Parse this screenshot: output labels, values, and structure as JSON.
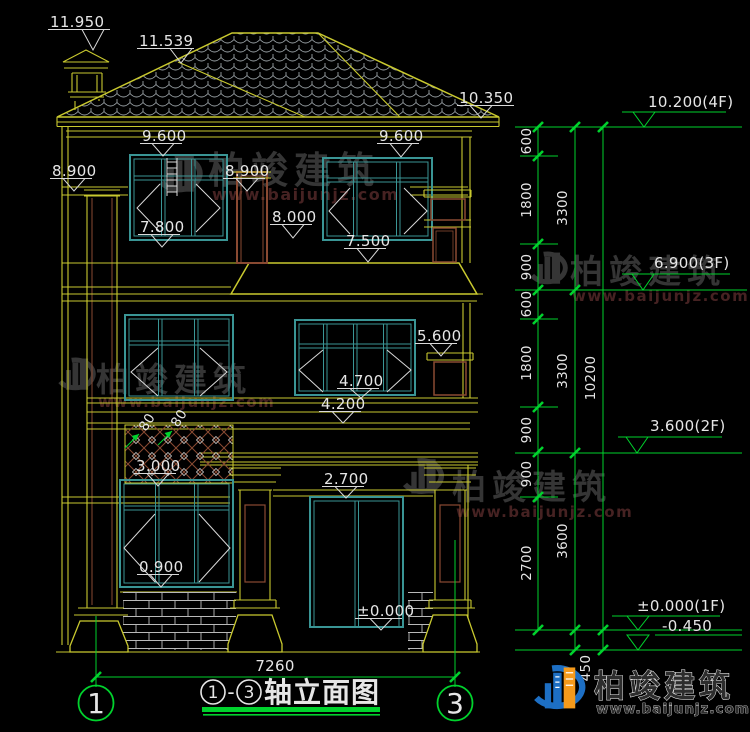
{
  "brand": {
    "name": "柏竣建筑",
    "site": "www.baijunjz.com"
  },
  "title_block": {
    "axis_start": "1",
    "dash": "-",
    "axis_end": "3",
    "title": "轴立面图"
  },
  "axis_bubbles": {
    "left": "1",
    "right": "3"
  },
  "bottom_dim": "7260",
  "levels": {
    "l4": "10.200(4F)",
    "l3": "6.900(3F)",
    "l2": "3.600(2F)",
    "l1": "±0.000(1F)",
    "lbase": "-0.450"
  },
  "chains": {
    "c1": [
      "600",
      "1800",
      "900",
      "600",
      "1800",
      "900",
      "900",
      "2700"
    ],
    "c2": [
      "3300",
      "3300",
      "3600"
    ],
    "c3": [
      "10200"
    ],
    "foundation": "450"
  },
  "el": {
    "chimney_top": "11.950",
    "ridge": "11.539",
    "eave_right": "10.350",
    "f3_win_top_left": "9.600",
    "f3_win_top_right": "9.600",
    "band_left": "8.900",
    "band_mid": "8.900",
    "f3_parapet_top": "8.000",
    "f3_sill": "7.800",
    "f3_parapet_sill": "7.500",
    "f2_parapet_top": "5.600",
    "f2_rail_top": "4.700",
    "f2_balcony": "4.200",
    "lattice_sill": "3.000",
    "f1_door_top": "2.700",
    "f1_sill": "0.900",
    "f1_floor": "±0.000",
    "lattice_w1": "80",
    "lattice_w2": "80"
  }
}
